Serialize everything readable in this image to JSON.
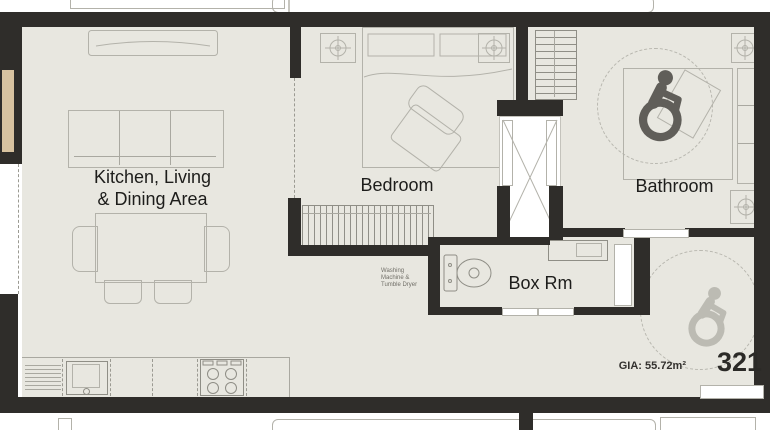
{
  "plan": {
    "unit_number": "321",
    "gia": "GIA: 55.72m²",
    "rooms": {
      "kitchen": {
        "label_line1": "Kitchen, Living",
        "label_line2": "& Dining Area"
      },
      "bedroom": {
        "label": "Bedroom"
      },
      "bathroom": {
        "label": "Bathroom"
      },
      "boxroom": {
        "label": "Box Rm"
      }
    },
    "annotations": {
      "washing_line1": "Washing",
      "washing_line2": "Machine &",
      "washing_line3": "Tumble Dryer"
    },
    "colors": {
      "floor": "#e8e7e0",
      "wall": "#2f2d2a",
      "furniture_line": "#b3b2aa",
      "icon_dark": "#605e59",
      "icon_light": "#bcbbb3",
      "balcony_tan": "#d8c3a0",
      "text": "#1d1d1b"
    }
  }
}
